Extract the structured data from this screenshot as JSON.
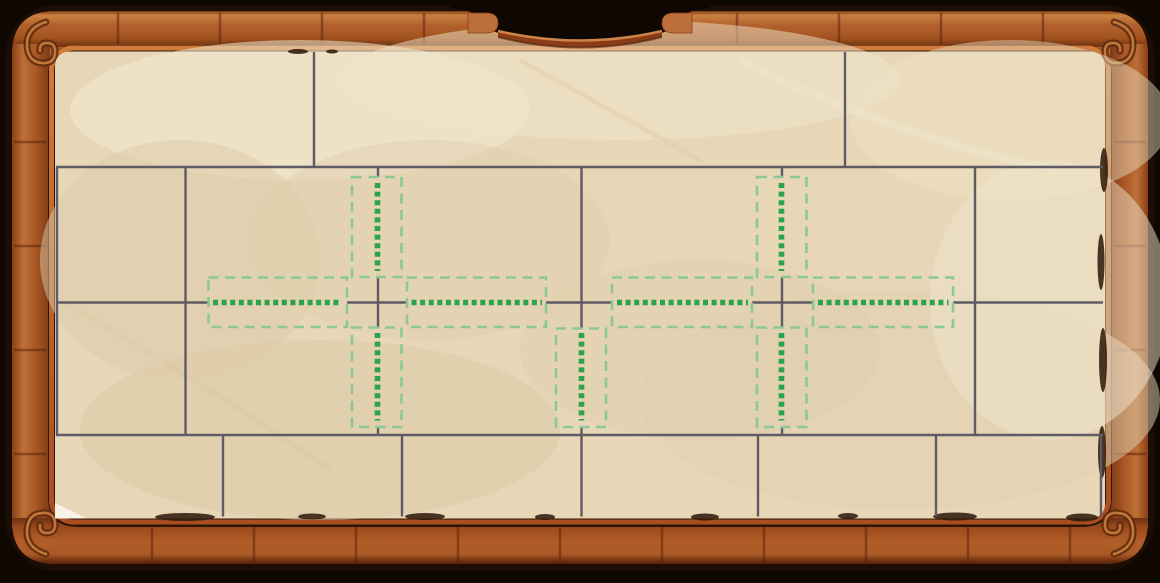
{
  "scene": {
    "description": "wooden-framed parchment puzzle board with brick-wall grid and green placement hints",
    "colors": {
      "backdrop": "#0e0702",
      "wood-mid": "#b4622f",
      "wood-light": "#c9813f",
      "wood-dark": "#7c3a16",
      "wood-seam": "#6e2d0f",
      "lip-orange": "#c4662d",
      "rim-shadow": "#2e1509",
      "paper-base": "#e7d7b7",
      "paper-light": "#f1e8d2",
      "paper-shade": "#dcc9a4",
      "tear-dark": "#311d0d",
      "grid-gray": "#5f5b64",
      "hint-box-green": "#8cc897",
      "hint-dot-green": "#2aa34b"
    }
  },
  "grid": {
    "line_color": "#5f5b64",
    "line_width": 2.4,
    "h_segments": [
      {
        "y": 167,
        "x1": 56,
        "x2": 1103
      },
      {
        "y": 302.5,
        "x1": 56,
        "x2": 208
      },
      {
        "y": 302.5,
        "x1": 347,
        "x2": 407
      },
      {
        "y": 302.5,
        "x1": 546,
        "x2": 612
      },
      {
        "y": 302.5,
        "x1": 752,
        "x2": 813
      },
      {
        "y": 302.5,
        "x1": 953,
        "x2": 1103
      },
      {
        "y": 435,
        "x1": 56,
        "x2": 1103
      }
    ],
    "v_segments": [
      {
        "x": 314,
        "y1": 52,
        "y2": 167
      },
      {
        "x": 845,
        "y1": 52,
        "y2": 167
      },
      {
        "x": 57,
        "y1": 167,
        "y2": 435
      },
      {
        "x": 185.5,
        "y1": 167,
        "y2": 435
      },
      {
        "x": 975,
        "y1": 167,
        "y2": 435
      },
      {
        "x": 378,
        "y1": 167,
        "y2": 177
      },
      {
        "x": 378,
        "y1": 277.5,
        "y2": 327.5
      },
      {
        "x": 378,
        "y1": 426,
        "y2": 435
      },
      {
        "x": 782,
        "y1": 167,
        "y2": 177
      },
      {
        "x": 782,
        "y1": 277.5,
        "y2": 328.5
      },
      {
        "x": 782,
        "y1": 426,
        "y2": 435
      },
      {
        "x": 581.5,
        "y1": 167,
        "y2": 328.5
      },
      {
        "x": 581.5,
        "y1": 426,
        "y2": 435
      },
      {
        "x": 223,
        "y1": 435,
        "y2": 516.5
      },
      {
        "x": 402,
        "y1": 435,
        "y2": 516.5
      },
      {
        "x": 581.5,
        "y1": 435,
        "y2": 516.5
      },
      {
        "x": 758,
        "y1": 435,
        "y2": 516.5
      },
      {
        "x": 936,
        "y1": 435,
        "y2": 516.5
      },
      {
        "x": 1101,
        "y1": 435,
        "y2": 516.5
      }
    ]
  },
  "hints": {
    "box_color": "#8cc897",
    "box_stroke": 2.6,
    "box_dash": [
      10,
      6.5
    ],
    "dot_color": "#2aa34b",
    "dot_stroke": 5.6,
    "dot_dash": [
      5,
      3.6
    ],
    "boxes": [
      {
        "id": "left-cross-west",
        "x": 208.5,
        "y": 277.5,
        "w": 138.5,
        "h": 49.5
      },
      {
        "id": "left-cross-east",
        "x": 407,
        "y": 277.5,
        "w": 139,
        "h": 49.5
      },
      {
        "id": "left-cross-north",
        "x": 352,
        "y": 177,
        "w": 49.5,
        "h": 100
      },
      {
        "id": "left-cross-south",
        "x": 352,
        "y": 327.5,
        "w": 49.5,
        "h": 99.5
      },
      {
        "id": "right-cross-west",
        "x": 612,
        "y": 277.5,
        "w": 140,
        "h": 49.5
      },
      {
        "id": "right-cross-east",
        "x": 813,
        "y": 277.5,
        "w": 140,
        "h": 49.5
      },
      {
        "id": "right-cross-north",
        "x": 757,
        "y": 177,
        "w": 49.5,
        "h": 100
      },
      {
        "id": "right-cross-south",
        "x": 757,
        "y": 327.5,
        "w": 49.5,
        "h": 99.5
      },
      {
        "id": "middle-south",
        "x": 556,
        "y": 328.5,
        "w": 50,
        "h": 98.5
      }
    ],
    "dotted_segments": [
      {
        "x1": 213,
        "y1": 302.5,
        "x2": 342,
        "y2": 302.5
      },
      {
        "x1": 411.5,
        "y1": 302.5,
        "x2": 542,
        "y2": 302.5
      },
      {
        "x1": 617,
        "y1": 302.5,
        "x2": 748,
        "y2": 302.5
      },
      {
        "x1": 818,
        "y1": 302.5,
        "x2": 948.5,
        "y2": 302.5
      },
      {
        "x1": 377.5,
        "y1": 183,
        "x2": 377.5,
        "y2": 271
      },
      {
        "x1": 377.5,
        "y1": 333,
        "x2": 377.5,
        "y2": 420.5
      },
      {
        "x1": 781.5,
        "y1": 183,
        "x2": 781.5,
        "y2": 271
      },
      {
        "x1": 781.5,
        "y1": 333,
        "x2": 781.5,
        "y2": 420.5
      },
      {
        "x1": 581.5,
        "y1": 333,
        "x2": 581.5,
        "y2": 420.5
      }
    ]
  }
}
